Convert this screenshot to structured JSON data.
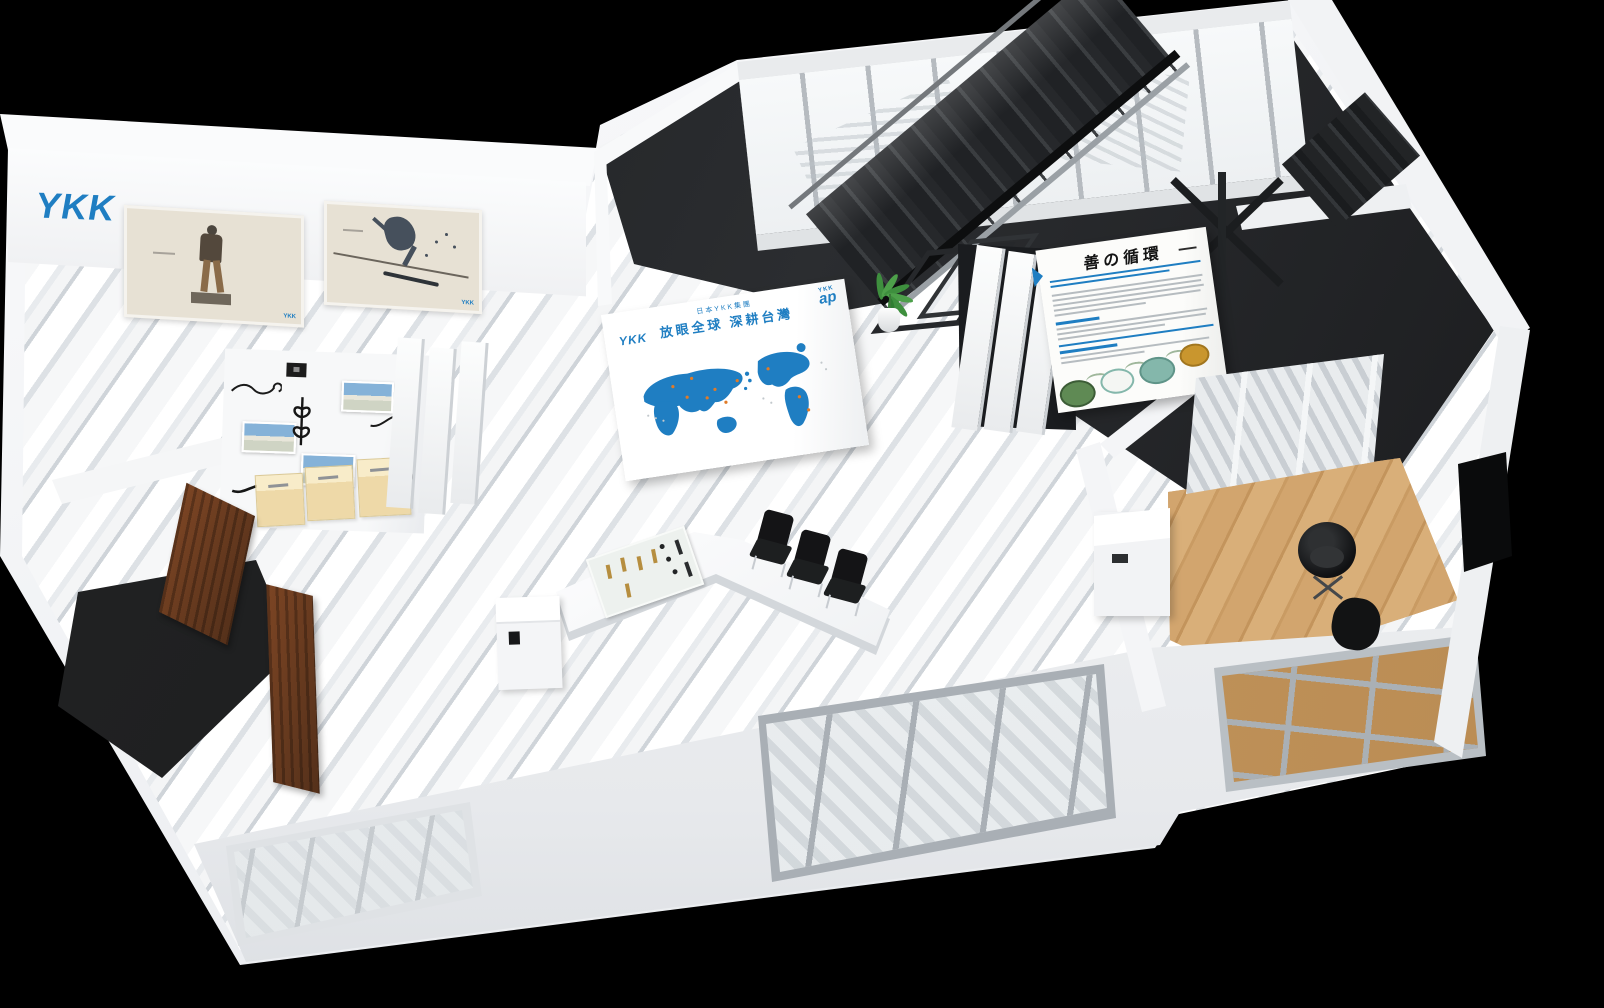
{
  "colors": {
    "background": "#000000",
    "ykk_blue": "#1f7ec2",
    "marble_light": "#f4f5f6",
    "marble_shadow": "#cfd4d9",
    "stair_dark": "#26282b",
    "chair_black": "#141416",
    "wood": "#c99b63",
    "door_brown": "#54301a",
    "cabinet_tan": "#eed9a8",
    "diagram_green": "#5f8a54",
    "diagram_teal": "#84b7ab",
    "diagram_gold": "#c9962e",
    "glass_mullion": "#b6bbc0"
  },
  "gallery": {
    "logo": "YKK",
    "posters": [
      {
        "name": "statue-ad",
        "logo": "YKK"
      },
      {
        "name": "skater-ad",
        "logo": "YKK"
      }
    ]
  },
  "map_wall": {
    "logo_left": "YKK",
    "subtitle": "日本YKK集團",
    "title": "放眼全球 深耕台灣",
    "ap_logo_line1": "YKK",
    "ap_logo_line2": "ap"
  },
  "philosophy_wall": {
    "title": "善の循環"
  }
}
